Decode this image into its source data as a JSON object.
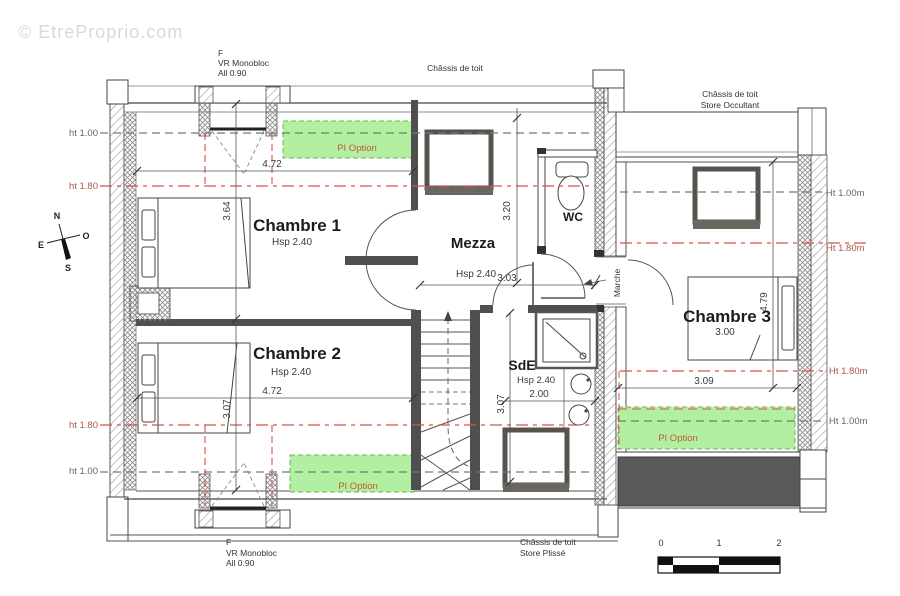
{
  "watermark": "© EtreProprio.com",
  "labels": {
    "window_top": {
      "line1": "F",
      "line2": "VR Monobloc",
      "line3": "All 0.90"
    },
    "window_bottom": {
      "line1": "F",
      "line2": "VR Monobloc",
      "line3": "All 0.90"
    },
    "roof_top": "Châssis de toit",
    "roof_right": {
      "line1": "Châssis de toit",
      "line2": "Store Occultant"
    },
    "roof_bottom": {
      "line1": "Châssis de toit",
      "line2": "Store Plissé"
    },
    "marche": "Marche",
    "pi_option": "PI Option"
  },
  "rooms": {
    "chambre1": {
      "name": "Chambre 1",
      "ceiling": "Hsp 2.40"
    },
    "chambre2": {
      "name": "Chambre 2",
      "ceiling": "Hsp 2.40"
    },
    "chambre3": {
      "name": "Chambre 3",
      "width": "3.00"
    },
    "mezzanine": {
      "name": "Mezza",
      "ceiling": "Hsp 2.40"
    },
    "shower_room": {
      "name": "SdE",
      "ceiling": "Hsp 2.40"
    },
    "wc": {
      "name": "WC"
    }
  },
  "dimensions": {
    "chambre1_width": "4.72",
    "chambre1_depth": "3.64",
    "chambre2_width": "4.72",
    "chambre2_depth": "3.07",
    "mezzanine_width": "3.03",
    "mezzanine_depth": "3.20",
    "shower_room_width": "2.00",
    "shower_room_depth": "3.07",
    "chambre3_width": "3.09",
    "chambre3_depth": "4.79"
  },
  "height_markers": {
    "left_top_100": "ht 1.00",
    "left_top_180": "ht 1.80",
    "left_bottom_180": "ht 1.80",
    "left_bottom_100": "ht 1.00",
    "right_top_100": "Ht 1.00m",
    "right_top_180": "Ht 1.80m",
    "right_bottom_180": "Ht 1.80m",
    "right_bottom_100": "Ht 1.00m"
  },
  "compass": {
    "north": "N",
    "south": "S",
    "east": "E",
    "west": "O"
  },
  "scale_bar": {
    "tick0": "0",
    "tick1": "1",
    "tick2": "2"
  },
  "colors": {
    "pi_option_fill": "#b3efa1",
    "pi_option_border": "#6fae5e",
    "pi_option_text": "#c05a35",
    "height_line_red": "#d94f4f",
    "height_line_gray": "#777777",
    "wall_dark": "#4f4f4f",
    "terrace_dark": "#595959",
    "watermark_gray": "#d9d9d9"
  }
}
